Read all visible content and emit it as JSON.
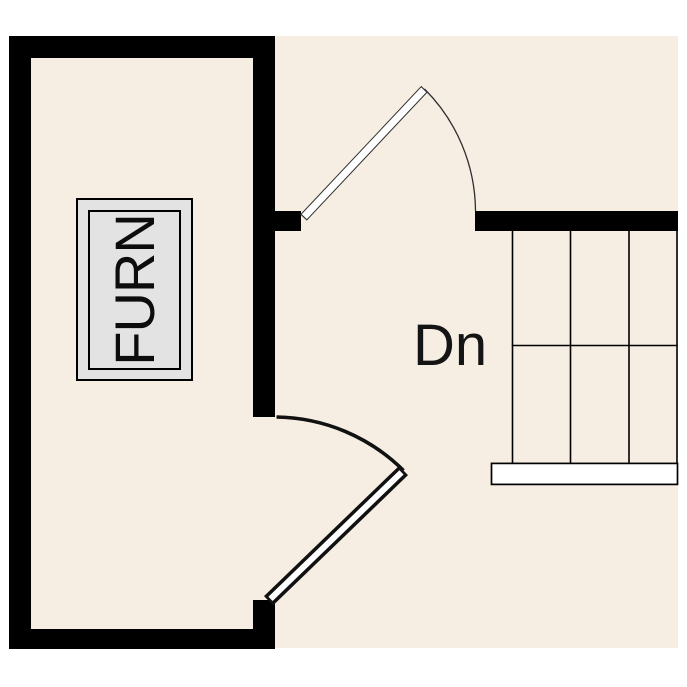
{
  "plan": {
    "furnace_label": "FURN",
    "stair_label": "Dn",
    "colors": {
      "page_background": "#ffffff",
      "floor": "#f6eee3",
      "wall": "#000000",
      "furnace_fill": "#e3e3e3",
      "landing_fill": "#ffffff",
      "line": "#000000"
    },
    "stairs": {
      "tread_columns": 3,
      "has_center_line": true,
      "direction_label": "Dn"
    },
    "doors": [
      {
        "location": "hall-top",
        "state": "open",
        "style": "thin-stroke"
      },
      {
        "location": "room-bottom-right",
        "state": "open",
        "style": "thick-stroke"
      }
    ]
  }
}
